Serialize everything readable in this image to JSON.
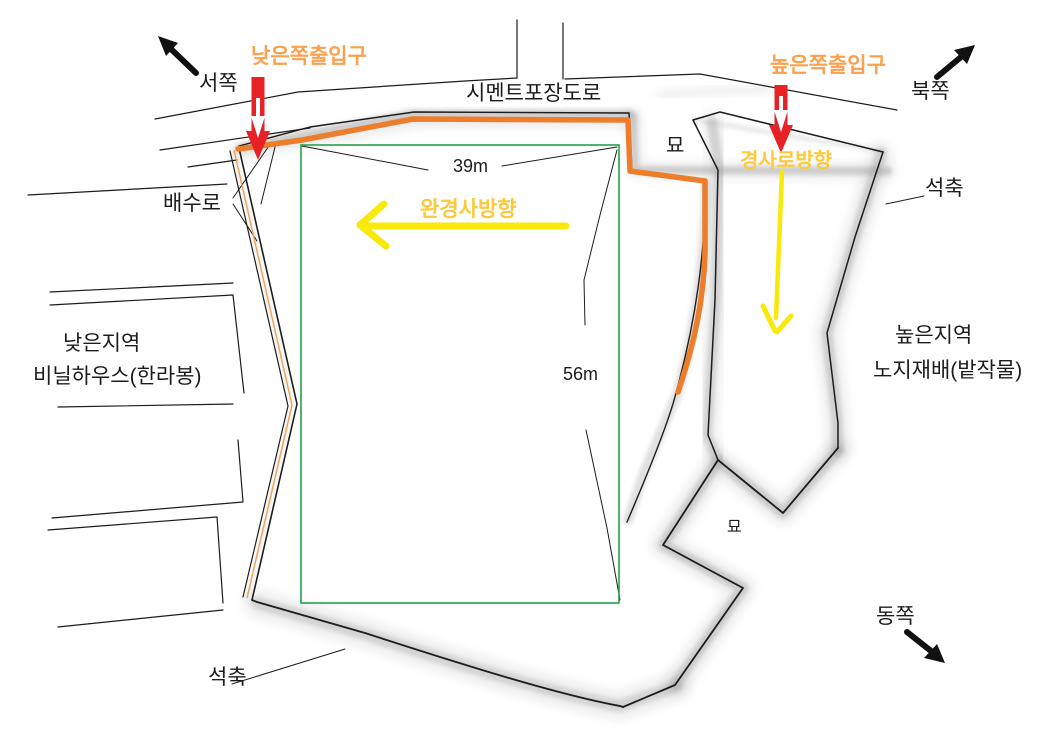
{
  "canvas": {
    "width": 1063,
    "height": 751,
    "background": "#ffffff"
  },
  "colors": {
    "access_path_orange": "#ed7c2b",
    "drain_line_orange": "#f0a055",
    "entrance_text_orange": "#fca04e",
    "slope_text_yellow": "#fcc93c",
    "arrow_yellow": "#f8e90b",
    "arrow_red": "#e82127",
    "survey_rect_green": "#26a148",
    "sketch_line_black": "#1c1c1c",
    "stone_wall_shadow_gray": "#9a9a9a"
  },
  "compass": {
    "west": "서쪽",
    "north": "북쪽",
    "east": "동쪽"
  },
  "labels": {
    "low_entrance": "낮은쪽출입구",
    "high_entrance": "높은쪽출입구",
    "cement_road": "시멘트포장도로",
    "grave_top": "묘",
    "grave_middle": "묘",
    "ramp_direction": "경사로방향",
    "gentle_slope_direction": "완경사방향",
    "stone_wall_right": "석축",
    "stone_wall_bottom": "석축",
    "drainage": "배수로",
    "low_area_line1": "낮은지역",
    "low_area_line2": "비닐하우스(한라봉)",
    "high_area_line1": "높은지역",
    "high_area_line2": "노지재배(밭작물)"
  },
  "dimensions": {
    "width_label": "39m",
    "height_label": "56m"
  }
}
